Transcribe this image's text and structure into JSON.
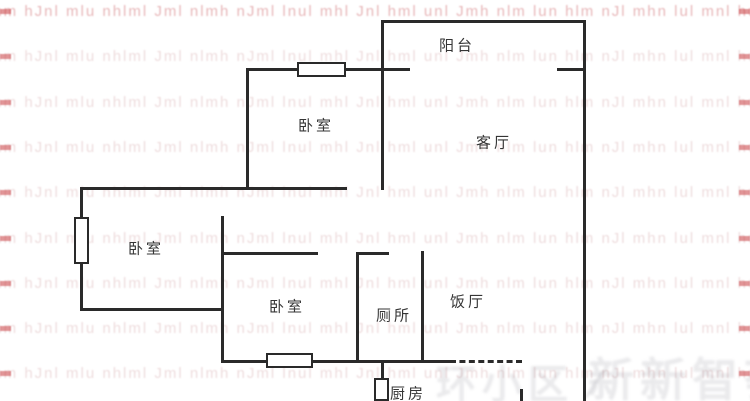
{
  "colors": {
    "wall": "#2a2a2a",
    "label_text": "#353535",
    "window_fill": "#ffffff",
    "watermark_row_pink": "rgba(193,128,133,0.28)",
    "watermark_row_red": "rgba(198,80,85,0.42)",
    "watermark_edge_red": "rgba(200,62,66,0.55)",
    "watermark_gray": "rgba(122,122,134,0.16)"
  },
  "rooms": [
    {
      "id": "balcony",
      "label": "阳台",
      "cx": 457,
      "cy": 45
    },
    {
      "id": "bedroom-top",
      "label": "卧室",
      "cx": 316,
      "cy": 125
    },
    {
      "id": "living-room",
      "label": "客厅",
      "cx": 494,
      "cy": 142
    },
    {
      "id": "bedroom-left",
      "label": "卧室",
      "cx": 146,
      "cy": 248
    },
    {
      "id": "bedroom-center",
      "label": "卧室",
      "cx": 287,
      "cy": 306
    },
    {
      "id": "toilet",
      "label": "厕所",
      "cx": 394,
      "cy": 315
    },
    {
      "id": "dining-room",
      "label": "饭厅",
      "cx": 468,
      "cy": 301
    },
    {
      "id": "kitchen",
      "label": "厨房",
      "cx": 408,
      "cy": 393
    }
  ],
  "walls": [
    {
      "id": "balcony-top",
      "x": 381,
      "y": 20,
      "w": 205,
      "h": 3
    },
    {
      "id": "balcony-sill-left",
      "x": 247,
      "y": 68,
      "w": 163,
      "h": 3
    },
    {
      "id": "balcony-sill-right",
      "x": 557,
      "y": 68,
      "w": 29,
      "h": 3
    },
    {
      "id": "bedroom-top-bottom",
      "x": 81,
      "y": 187,
      "w": 266,
      "h": 3
    },
    {
      "id": "bedroom-center-top",
      "x": 221,
      "y": 252,
      "w": 97,
      "h": 3
    },
    {
      "id": "toilet-top",
      "x": 356,
      "y": 252,
      "w": 33,
      "h": 3
    },
    {
      "id": "bedroom-left-bottom",
      "x": 81,
      "y": 308,
      "w": 143,
      "h": 3
    },
    {
      "id": "bottom-main",
      "x": 221,
      "y": 360,
      "w": 229,
      "h": 3
    },
    {
      "id": "bottom-sliding",
      "x": 450,
      "y": 360,
      "w": 72,
      "h": 3,
      "dashed": true
    },
    {
      "id": "living-left",
      "x": 381,
      "y": 20,
      "w": 3,
      "h": 170
    },
    {
      "id": "outer-right",
      "x": 583,
      "y": 20,
      "w": 3,
      "h": 381
    },
    {
      "id": "bedroom-top-left",
      "x": 246,
      "y": 68,
      "w": 3,
      "h": 122
    },
    {
      "id": "outer-left",
      "x": 80,
      "y": 187,
      "w": 3,
      "h": 124
    },
    {
      "id": "bedroom-center-left",
      "x": 221,
      "y": 216,
      "w": 3,
      "h": 147
    },
    {
      "id": "toilet-left",
      "x": 356,
      "y": 252,
      "w": 3,
      "h": 111
    },
    {
      "id": "toilet-right",
      "x": 421,
      "y": 251,
      "w": 3,
      "h": 112
    },
    {
      "id": "kitchen-left",
      "x": 381,
      "y": 360,
      "w": 3,
      "h": 19
    },
    {
      "id": "kitchen-right",
      "x": 520,
      "y": 389,
      "w": 3,
      "h": 12
    }
  ],
  "windows": [
    {
      "id": "window-bedroom-top",
      "x": 297,
      "y": 62,
      "w": 49,
      "h": 15
    },
    {
      "id": "window-bedroom-left",
      "x": 74,
      "y": 217,
      "w": 15,
      "h": 47
    },
    {
      "id": "window-bedroom-center",
      "x": 266,
      "y": 353,
      "w": 47,
      "h": 15
    },
    {
      "id": "window-kitchen",
      "x": 374,
      "y": 378,
      "w": 15,
      "h": 23
    }
  ],
  "watermark": {
    "rows": {
      "count": 9,
      "start_y": 3,
      "step": 45.3,
      "text": "lnm hJnl mlu nhlml Jml nlmh nJml lnul mhl Jnl hml unl Jmh nlm lun hlm nJl mhn lul mnl hul nml"
    },
    "bottom_left": {
      "text": "环小区 ∕"
    },
    "bottom_right": {
      "text": "新新智荟"
    }
  }
}
